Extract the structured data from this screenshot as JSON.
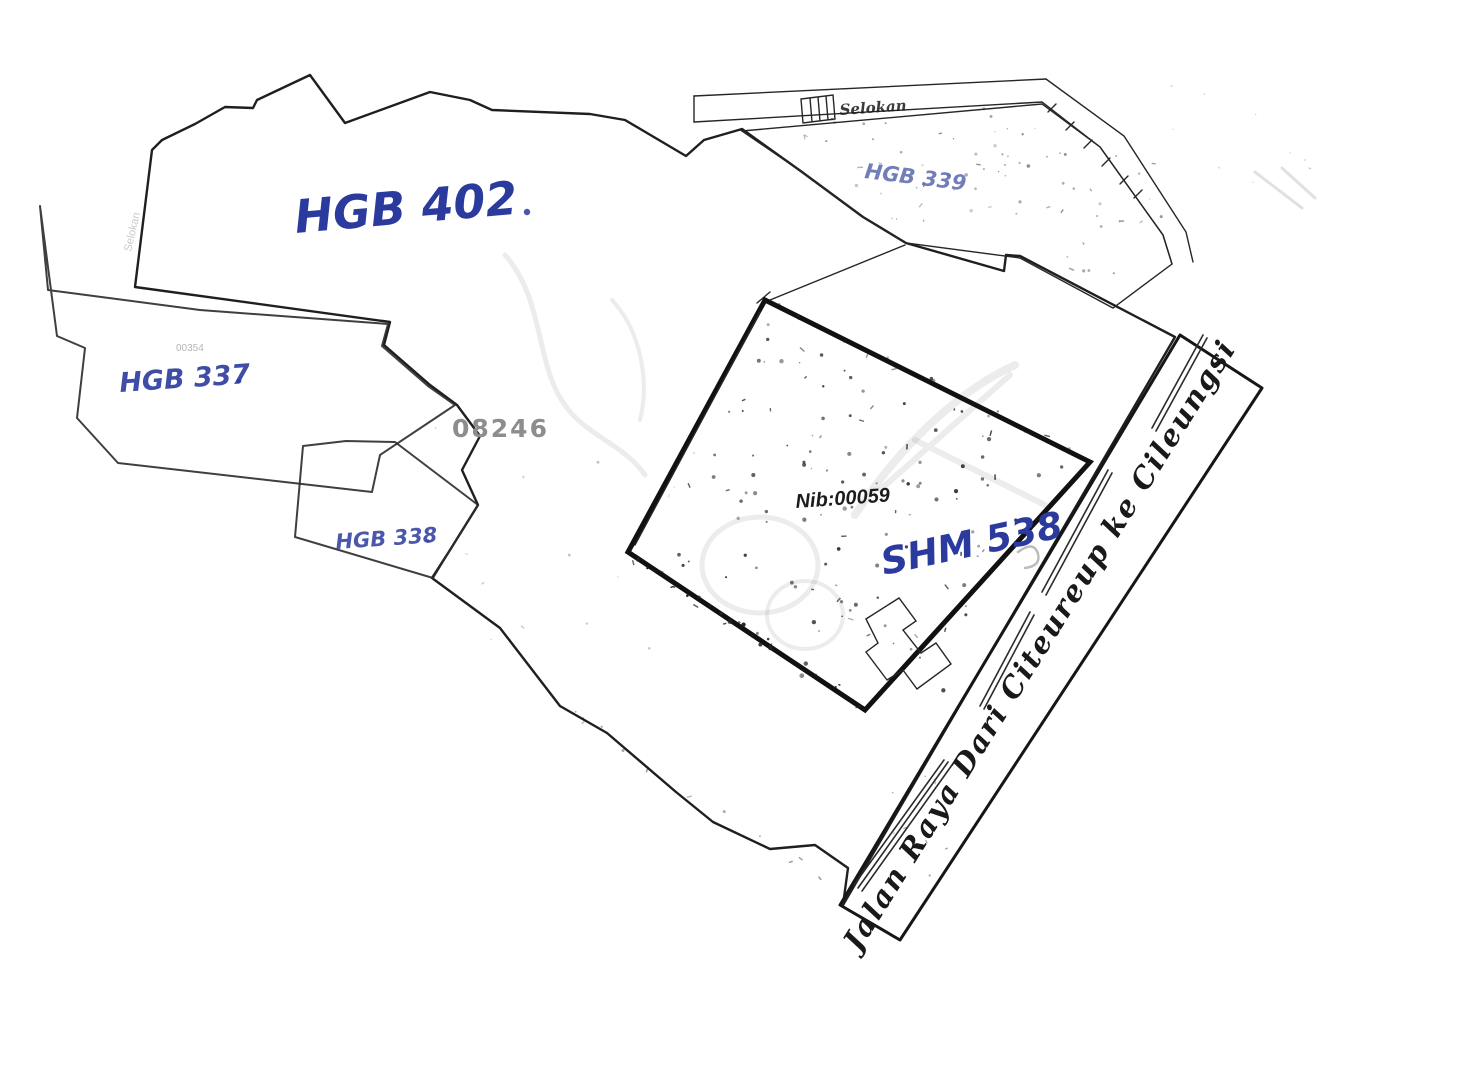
{
  "map": {
    "labels": {
      "hgb402": "HGB 402",
      "hgb339": "HGB 339",
      "hgb337": "HGB 337",
      "hgb337_code": "00354",
      "hgb338": "HGB 338",
      "shm538": "SHM 538",
      "nib": "Nib:00059",
      "plot_code": "08246",
      "road": "Jalan Raya Dari Citeureup ke Cileungsi",
      "canal": "Selokan",
      "canal_left": "Selokan"
    },
    "colors": {
      "handwriting_blue": "#2b3a9d",
      "scan_ink_black": "#1c1c1c",
      "faint_gray": "#9a9a9a"
    }
  }
}
